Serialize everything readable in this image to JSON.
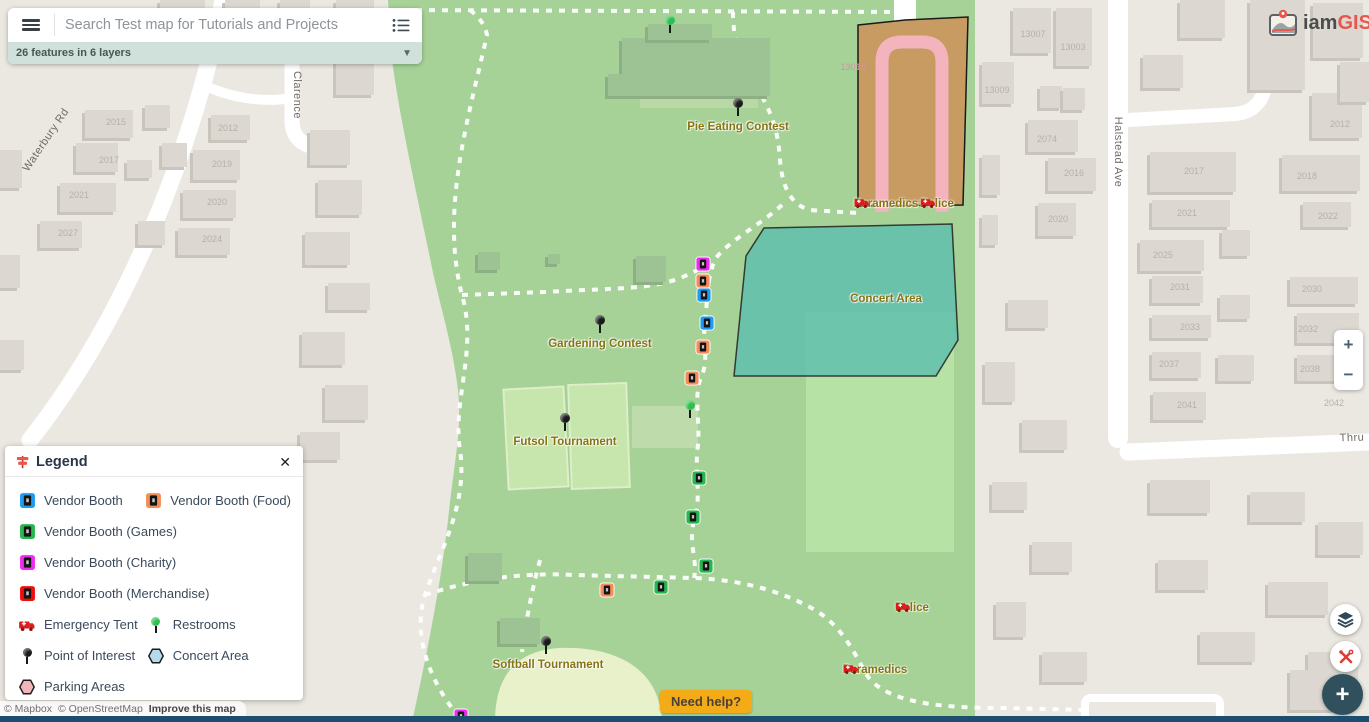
{
  "search": {
    "placeholder": "Search Test map for Tutorials and Projects",
    "features_summary": "26 features in 6 layers"
  },
  "logo": {
    "prefix": "iam",
    "suffix": "GIS"
  },
  "help": {
    "label": "Need help?"
  },
  "attribution": {
    "mapbox": "© Mapbox",
    "osm": "© OpenStreetMap",
    "improve": "Improve this map"
  },
  "controls": {
    "zoom_in": "+",
    "zoom_out": "−",
    "add": "+"
  },
  "colors": {
    "booth_plain": "#1e9bf0",
    "booth_food": "#f68d59",
    "booth_games": "#28b64e",
    "booth_charity": "#ef2bef",
    "booth_merch": "#f20d0d",
    "restroom": "#2dbe4e",
    "poi": "#1a1a1a",
    "concert_fill": "#b5d9ed",
    "parking_fill": "#f2b5b9",
    "ambulance_red": "#d81e1e",
    "accent_red": "#e8574d",
    "navy": "#31505e"
  },
  "legend": {
    "title": "Legend",
    "close": "✕",
    "rows": [
      [
        {
          "icon": "booth",
          "type": "plain",
          "label": "Vendor Booth"
        },
        {
          "icon": "booth",
          "type": "food",
          "label": "Vendor Booth (Food)"
        }
      ],
      [
        {
          "icon": "booth",
          "type": "games",
          "label": "Vendor Booth (Games)"
        }
      ],
      [
        {
          "icon": "booth",
          "type": "charity",
          "label": "Vendor Booth (Charity)"
        }
      ],
      [
        {
          "icon": "booth",
          "type": "merch",
          "label": "Vendor Booth (Merchandise)"
        }
      ],
      [
        {
          "icon": "ambulance",
          "label": "Emergency Tent"
        },
        {
          "icon": "pin",
          "kind": "restroom",
          "label": "Restrooms"
        }
      ],
      [
        {
          "icon": "pin",
          "kind": "poi",
          "label": "Point of Interest"
        },
        {
          "icon": "hex",
          "fill_key": "concert_fill",
          "label": "Concert Area"
        }
      ],
      [
        {
          "icon": "hex",
          "fill_key": "parking_fill",
          "label": "Parking Areas"
        }
      ]
    ]
  },
  "map": {
    "street_labels": [
      {
        "text": "Waterbury Rd",
        "x": 46,
        "y": 140,
        "rot": -56
      },
      {
        "text": "Clarence",
        "x": 297,
        "y": 95,
        "rot": 90
      },
      {
        "text": "Halstead Ave",
        "x": 1118,
        "y": 152,
        "rot": 90
      },
      {
        "text": "Thru",
        "x": 1352,
        "y": 438,
        "rot": -2
      }
    ],
    "place_labels": [
      {
        "text": "Pie Eating Contest",
        "x": 738,
        "y": 121
      },
      {
        "text": "Gardening Contest",
        "x": 600,
        "y": 338
      },
      {
        "text": "Futsol Tournament",
        "x": 565,
        "y": 436
      },
      {
        "text": "Softball Tournament",
        "x": 548,
        "y": 659
      },
      {
        "text": "Concert Area",
        "x": 886,
        "y": 293
      }
    ],
    "tents": [
      {
        "label": "Paramedics",
        "x": 886,
        "y": 203
      },
      {
        "label": "Police",
        "x": 937,
        "y": 203
      },
      {
        "label": "Police",
        "x": 912,
        "y": 607
      },
      {
        "label": "Paramedics",
        "x": 875,
        "y": 669
      }
    ],
    "pins": [
      {
        "kind": "poi",
        "x": 738,
        "y": 117
      },
      {
        "kind": "poi",
        "x": 600,
        "y": 334
      },
      {
        "kind": "poi",
        "x": 565,
        "y": 432
      },
      {
        "kind": "poi",
        "x": 546,
        "y": 655
      },
      {
        "kind": "restroom",
        "x": 670,
        "y": 34
      },
      {
        "kind": "restroom",
        "x": 690,
        "y": 419
      }
    ],
    "booths": [
      {
        "type": "charity",
        "x": 703,
        "y": 264
      },
      {
        "type": "food",
        "x": 703,
        "y": 281
      },
      {
        "type": "plain",
        "x": 704,
        "y": 295
      },
      {
        "type": "plain",
        "x": 707,
        "y": 323
      },
      {
        "type": "food",
        "x": 703,
        "y": 347
      },
      {
        "type": "food",
        "x": 692,
        "y": 378
      },
      {
        "type": "games",
        "x": 699,
        "y": 478
      },
      {
        "type": "games",
        "x": 693,
        "y": 517
      },
      {
        "type": "games",
        "x": 706,
        "y": 566
      },
      {
        "type": "games",
        "x": 661,
        "y": 587
      },
      {
        "type": "food",
        "x": 607,
        "y": 590
      },
      {
        "type": "charity",
        "x": 461,
        "y": 716
      }
    ],
    "building_numbers": [
      {
        "text": "2015",
        "x": 116,
        "y": 122
      },
      {
        "text": "2017",
        "x": 109,
        "y": 160
      },
      {
        "text": "2021",
        "x": 79,
        "y": 195
      },
      {
        "text": "2027",
        "x": 68,
        "y": 233
      },
      {
        "text": "2012",
        "x": 228,
        "y": 128
      },
      {
        "text": "2019",
        "x": 222,
        "y": 164
      },
      {
        "text": "2020",
        "x": 217,
        "y": 202
      },
      {
        "text": "2024",
        "x": 212,
        "y": 239
      },
      {
        "text": "13007",
        "x": 1033,
        "y": 34
      },
      {
        "text": "13003",
        "x": 1073,
        "y": 47
      },
      {
        "text": "13009",
        "x": 997,
        "y": 90
      },
      {
        "text": "2074",
        "x": 1047,
        "y": 139
      },
      {
        "text": "2016",
        "x": 1074,
        "y": 173
      },
      {
        "text": "2020",
        "x": 1058,
        "y": 219
      },
      {
        "text": "13018",
        "x": 853,
        "y": 67,
        "tint": "pink"
      },
      {
        "text": "2012",
        "x": 1340,
        "y": 124
      },
      {
        "text": "2017",
        "x": 1194,
        "y": 171
      },
      {
        "text": "2018",
        "x": 1307,
        "y": 176
      },
      {
        "text": "2021",
        "x": 1187,
        "y": 213
      },
      {
        "text": "2022",
        "x": 1328,
        "y": 216
      },
      {
        "text": "2025",
        "x": 1163,
        "y": 255
      },
      {
        "text": "2031",
        "x": 1180,
        "y": 287
      },
      {
        "text": "2030",
        "x": 1312,
        "y": 289
      },
      {
        "text": "2033",
        "x": 1190,
        "y": 327
      },
      {
        "text": "2032",
        "x": 1308,
        "y": 329
      },
      {
        "text": "2037",
        "x": 1169,
        "y": 364
      },
      {
        "text": "2038",
        "x": 1310,
        "y": 369
      },
      {
        "text": "2041",
        "x": 1187,
        "y": 405
      },
      {
        "text": "2042",
        "x": 1334,
        "y": 403
      }
    ]
  }
}
